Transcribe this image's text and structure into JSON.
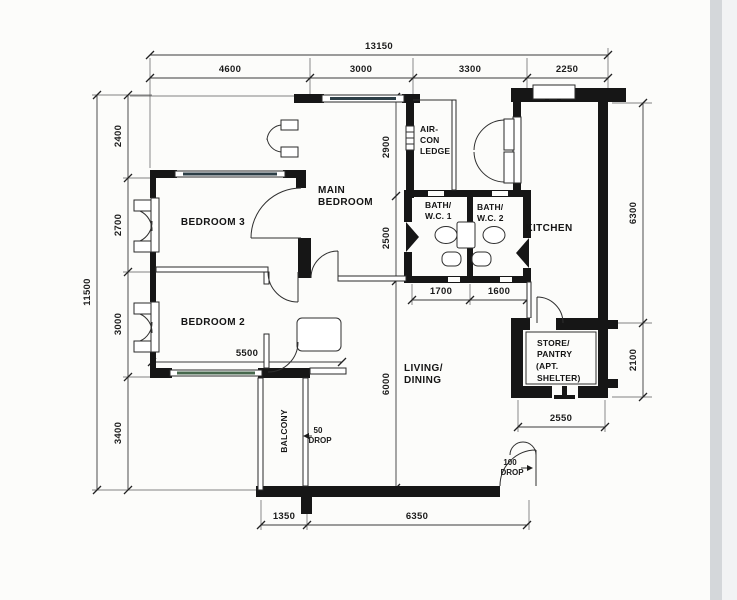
{
  "colors": {
    "paper": "#fcfcfa",
    "ink": "#161616",
    "scan_edge": "#d4d7da",
    "scan_edge_light": "#f2f3f4",
    "window_stripe": "#2c3e46",
    "window_stripe_green": "#47684d"
  },
  "rooms": {
    "bedroom3": "BEDROOM 3",
    "bedroom2": "BEDROOM 2",
    "main_bedroom_l1": "MAIN",
    "main_bedroom_l2": "BEDROOM",
    "aircon_l1": "AIR-",
    "aircon_l2": "CON",
    "aircon_l3": "LEDGE",
    "bath1_l1": "BATH/",
    "bath1_l2": "W.C. 1",
    "bath2_l1": "BATH/",
    "bath2_l2": "W.C. 2",
    "kitchen": "KITCHEN",
    "living_l1": "LIVING/",
    "living_l2": "DINING",
    "balcony": "BALCONY",
    "store_l1": "STORE/",
    "store_l2": "PANTRY",
    "store_l3": "(APT.",
    "store_l4": "SHELTER)"
  },
  "dimensions": {
    "top": {
      "overall": "13150",
      "seg1": "4600",
      "seg2": "3000",
      "seg3": "3300",
      "seg4": "2250"
    },
    "left": {
      "overall": "11500",
      "seg1": "2400",
      "seg2": "2700",
      "seg3": "3000",
      "seg4": "3400"
    },
    "right": {
      "seg1": "6300",
      "seg2": "2100"
    },
    "bottom": {
      "seg1": "1350",
      "seg2": "6350"
    },
    "interior": {
      "v1": "2900",
      "v2": "2500",
      "v3": "6000",
      "h1": "1700",
      "h2": "1600",
      "h3": "5500",
      "h4": "2550"
    }
  },
  "annotations": {
    "balcony_drop_l1": "50",
    "balcony_drop_l2": "DROP",
    "entrance_drop_l1": "100",
    "entrance_drop_l2": "DROP"
  }
}
